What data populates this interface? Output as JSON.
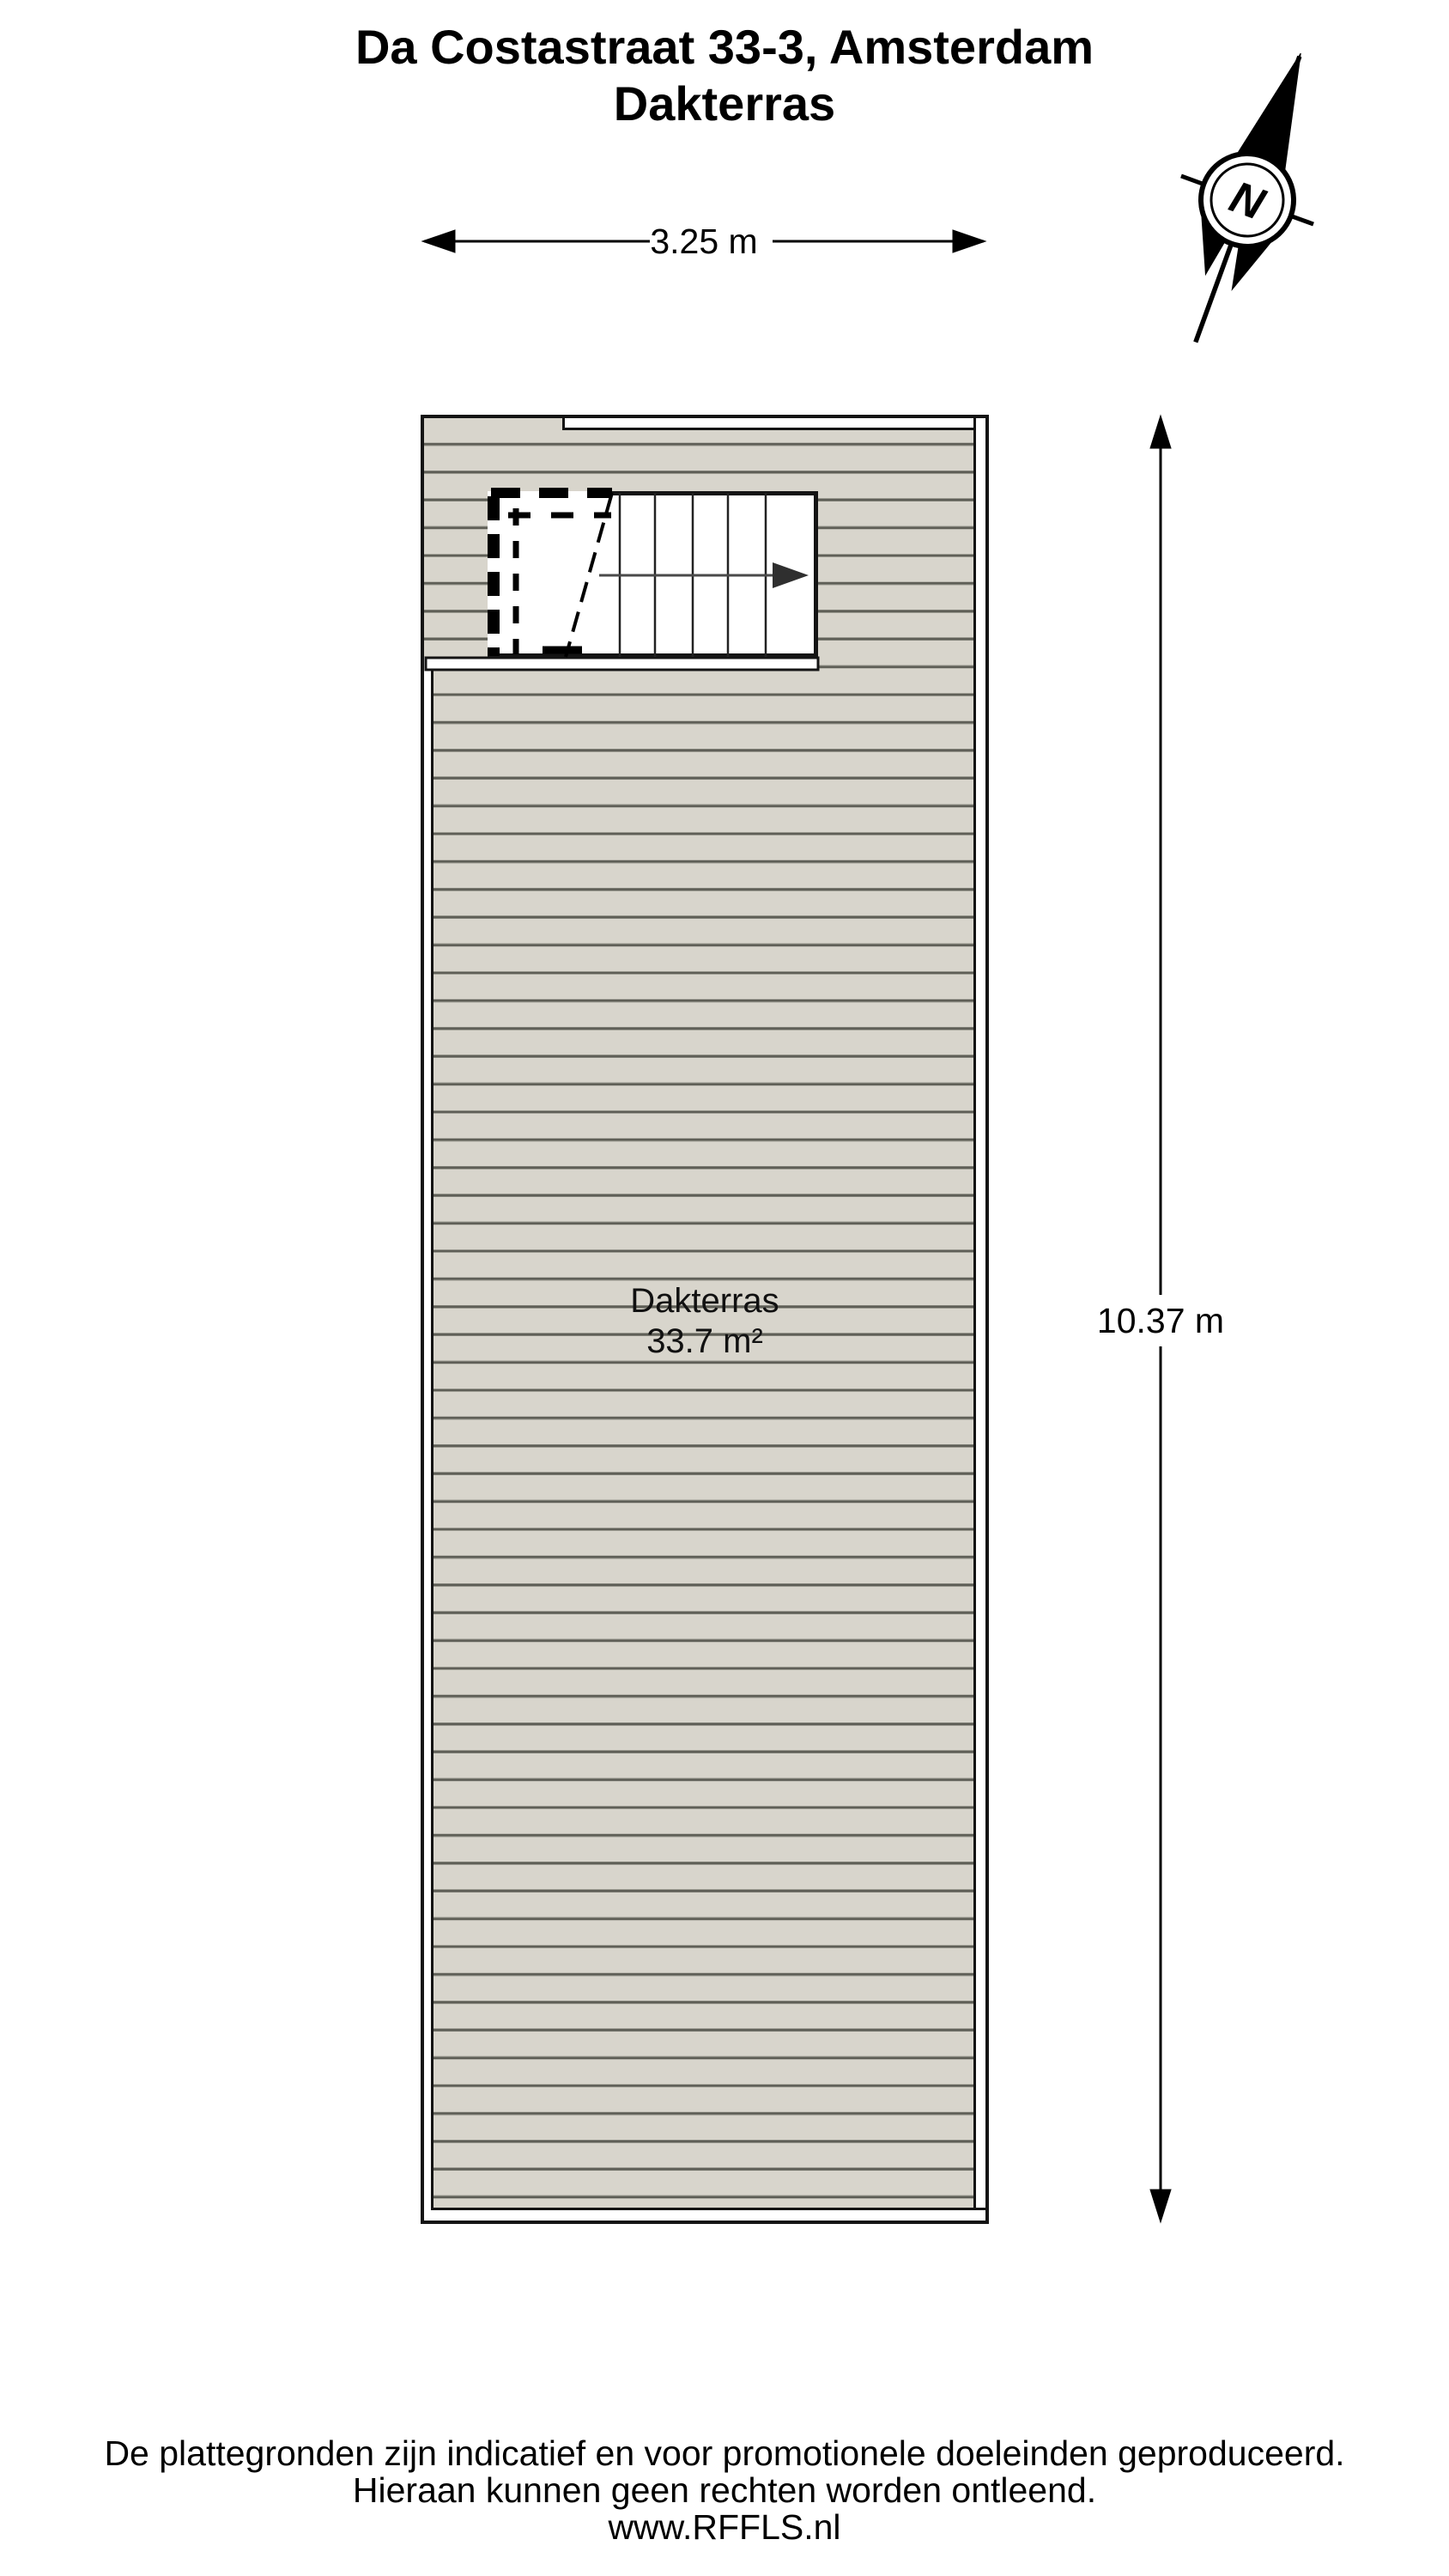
{
  "title": {
    "line1": "Da Costastraat 33-3, Amsterdam",
    "line2": "Dakterras"
  },
  "compass": {
    "north_label": "N"
  },
  "dimensions": {
    "width_label": "3.25 m",
    "height_label": "10.37 m"
  },
  "room": {
    "name": "Dakterras",
    "area": "33.7 m²"
  },
  "footer": {
    "line1": "De plattegronden zijn indicatief en voor promotionele doeleinden geproduceerd.",
    "line2": "Hieraan kunnen geen rechten worden ontleend.",
    "line3": "www.RFFLS.nl"
  },
  "colors": {
    "deck": "#d8d5cc",
    "plank_line": "#5f5f57",
    "plank_edge": "#9a998f",
    "outline": "#141414",
    "paper": "#ffffff",
    "arrow": "#2f2f2f"
  }
}
